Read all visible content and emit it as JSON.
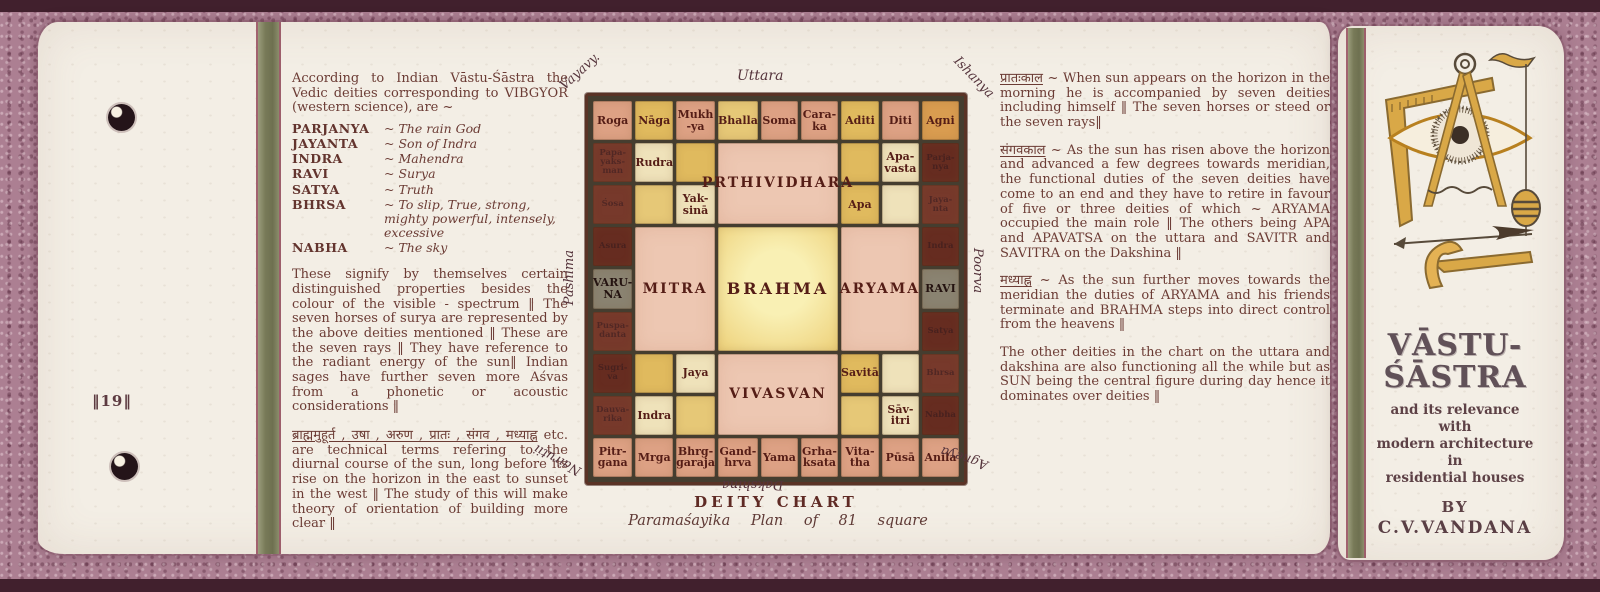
{
  "document": {
    "page_number": "‖19‖",
    "left_column": {
      "intro": "According to Indian Vāstu-Śāstra the Vedic deities corresponding to VIBGYOR (western science), are ~",
      "deities": [
        {
          "name": "PARJANYA",
          "meaning": "The rain God"
        },
        {
          "name": "JAYANTA",
          "meaning": "Son of Indra"
        },
        {
          "name": "INDRA",
          "meaning": "Mahendra"
        },
        {
          "name": "RAVI",
          "meaning": "Surya"
        },
        {
          "name": "SATYA",
          "meaning": "Truth"
        },
        {
          "name": "BHRSA",
          "meaning": "To slip, True, strong, mighty powerful, intensely, excessive"
        },
        {
          "name": "NABHA",
          "meaning": "The sky"
        }
      ],
      "para2": "These signify by themselves certain distinguished properties besides the colour of the visible - spectrum ‖ The seven horses of surya are represented by the above deities mentioned ‖ These are the seven rays ‖ They have reference to the radiant energy of the sun‖ Indian sages have further seven more Aśvas from a phonetic or acoustic considerations ‖",
      "para3_head": "ब्राह्ममुहूर्त , उषा , अरुण , प्रातः , संगव , मध्याह्न",
      "para3_body": "etc. are technical terms refering to the diurnal course of the sun, long before its rise on the horizon in the east to sunset in the west ‖ The study of this will make theory of orientation of building more clear ‖"
    },
    "right_column": {
      "para1_head": "प्रातःकाल",
      "para1_body": " ~ When sun appears on the horizon in the morning he is accompanied by seven deities including himself ‖ The seven horses or steed or the seven rays‖",
      "para2_head": "संगवकाल",
      "para2_body": " ~ As the sun has risen above the horizon and advanced a few degrees towards meridian, the functional duties of the seven deities have come to an end and they have to retire in favour of five or three deities of which ~ ARYAMA occupied the main role ‖ The others being APA and APAVATSA on the uttara and SAVITR and SAVITRA on the Dakshina ‖",
      "para3_head": "मध्याह्न",
      "para3_body": " ~ As the sun further moves towards the meridian the duties of ARYAMA and his friends terminate and BRAHMA steps into direct control from the heavens ‖",
      "para4_body": "The other deities in the chart on the uttara and dakshina are also functioning all the while but as SUN being the central figure during day hence it dominates over deities ‖"
    },
    "cover": {
      "title_line1": "VĀSTU-",
      "title_line2": "ŚĀSTRA",
      "subtitle_lines": [
        "and its relevance",
        "with",
        "modern architecture",
        "in",
        "residential houses"
      ],
      "by": "BY",
      "author": "C.V.VANDANA"
    }
  },
  "chart_data": {
    "type": "table",
    "title": "DEITY CHART",
    "subtitle": "Paramaśayika Plan of 81 square",
    "directions": {
      "top": "Uttara",
      "top_left": "Vayavy.",
      "top_right": "Ishanya",
      "left": "Pashima",
      "right": "Poorva",
      "bottom": "Dakshina",
      "bottom_left": "Nairutii",
      "bottom_right": "Agneya"
    },
    "north_row": [
      "Roga",
      "Nāga",
      "Mukh\n-ya",
      "Bhalla",
      "Soma",
      "Cara-\nka",
      "Aditi",
      "Diti",
      "Agni"
    ],
    "west_col": [
      "Papa-\nyaks-\nman",
      "Śosa",
      "Asura",
      "VARU-\nNA",
      "Puspa-\ndanta",
      "Sugri-\nva",
      "Dauva-\nrika"
    ],
    "east_col": [
      "Parja-\nnya",
      "Jaya-\nnta",
      "Indra",
      "RAVI",
      "Satya",
      "Bhrsa",
      "Nabha"
    ],
    "south_row": [
      "Pitr-\ngana",
      "Mrga",
      "Bhrg-\ngaraja",
      "Gand-\nhrva",
      "Yama",
      "Grha-\nksata",
      "Vita-\ntha",
      "Pūsā",
      "Anila"
    ],
    "inner_blocks": {
      "north": "PRTHIVIDHARA",
      "west": "MITRA",
      "center": "BRAHMA",
      "east": "ARYAMA",
      "south": "VIVASVAN"
    },
    "corner_blocks": {
      "nw": [
        "Rudra",
        "Yak-\nsinā"
      ],
      "ne": [
        "Apa-\nvasta",
        "Apa"
      ],
      "sw": [
        "Jaya",
        "Indra"
      ],
      "se": [
        "Savitā",
        "Sāv-\nitri"
      ]
    }
  },
  "colors": {
    "background_mauve": "#ac7f92",
    "paper": "#f3eee5",
    "ink": "#6b3b34",
    "grid_line": "#453d2f",
    "cell_salmon": "#dda184",
    "cell_gold": "#e0ba5e",
    "cell_dark_brown": "#77392b",
    "cell_gray": "#8a8371",
    "block_pink": "#edc7b2",
    "block_yellow": "#f3dc8e",
    "olive_strip": "#787a58"
  }
}
